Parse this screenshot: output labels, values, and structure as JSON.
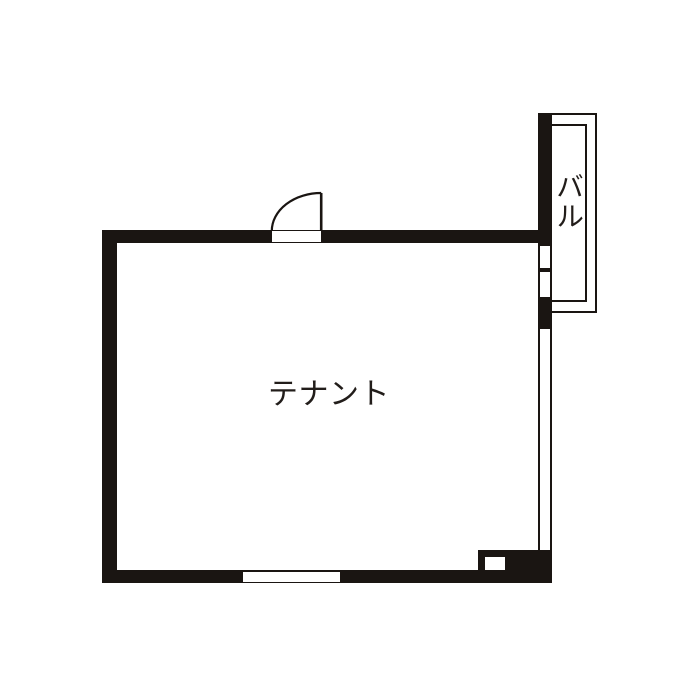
{
  "floor_plan": {
    "room_label": "テナント",
    "balcony_label": "バル"
  },
  "colors": {
    "wall": "#1a1512",
    "text": "#221d1a",
    "bg": "#ffffff"
  }
}
